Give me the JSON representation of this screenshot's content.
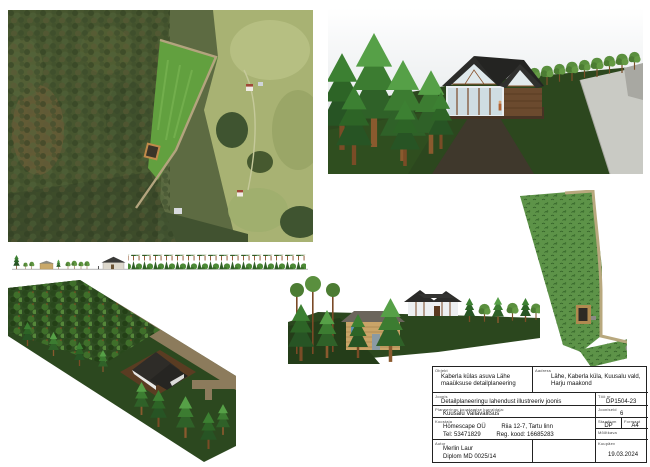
{
  "title_block": {
    "object_label": "Objekt",
    "object_value": "Kaberla külas asuva Lähe maaüksuse detailplaneering",
    "address_label": "Aadress",
    "address_value": "Lähe, Kaberla küla, Kuusalu vald, Harju maakond",
    "drawing_label": "Joonis",
    "drawing_value": "Detailplaneeringu lahendust illustreeriv joonis",
    "work_no_label": "Töö nr",
    "work_no_value": "DP1504-23",
    "organizer_label": "Planeeringu koostamise korraldaja:",
    "organizer_value": "Kuusalu Vallavalitsus",
    "sheets_label": "Jooniseid",
    "sheets_value": "6",
    "company_label": "Koostaja",
    "company_name": "Homescape OÜ",
    "company_address": "Riia 12-7, Tartu linn",
    "company_phone": "Tel: 53471829",
    "company_reg": "Reg. kood: 16685283",
    "stage_label": "Staadium",
    "stage_value": "DP",
    "format_label": "Formaat",
    "format_value": "A4",
    "scale_label": "Mõõtkava",
    "scale_value": "",
    "author_label": "Autor",
    "author_name": "Merlin Laur",
    "author_cert": "Diplom MD 0025/14",
    "date_label": "Kuupäev",
    "date_value": "19.03.2024"
  },
  "palette": {
    "forest_dark": "#3c4a2a",
    "clearing_green": "#62a03f",
    "meadow_green": "#a8b273",
    "render_ground": "#2c471e",
    "roof_dark": "#2c2c2a",
    "wood_brown": "#8a5530",
    "road_gray": "#c9cac4",
    "road_tan": "#b8a87e",
    "siteplan_green": "#5d9348"
  }
}
